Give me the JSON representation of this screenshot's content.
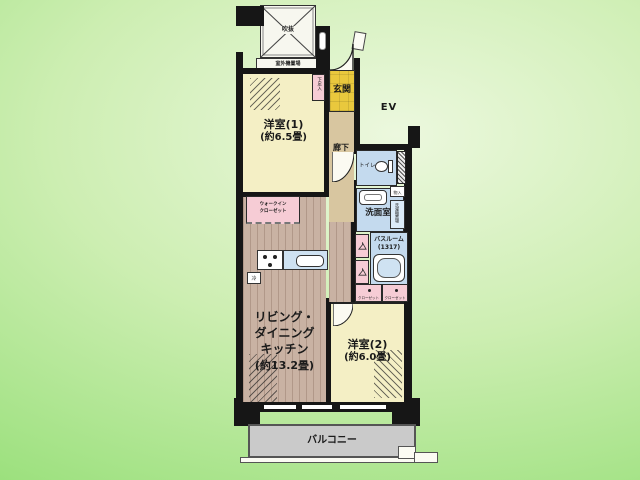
{
  "scene": {
    "ev_label": "EV"
  },
  "plan": {
    "void": "吹抜",
    "outdoor_unit": "室外機置場",
    "entrance": "玄関",
    "shoe_cabinet": "下足入",
    "hallway": "廊下",
    "toilet": "トイレ",
    "washroom": "洗面室",
    "bathroom_name": "バスルーム",
    "bathroom_size": "(1317)",
    "storage": "物入",
    "laundry": "洗濯機置場",
    "room1_name": "洋室(1)",
    "room1_size": "(約6.5畳)",
    "room2_name": "洋室(2)",
    "room2_size": "(約6.0畳)",
    "ldk_line1": "リビング・",
    "ldk_line2": "ダイニング",
    "ldk_line3": "キッチン",
    "ldk_size": "(約13.2畳)",
    "wic_line1": "ウォークイン",
    "wic_line2": "クローゼット",
    "closet_left": "クローゼット",
    "closet_right": "クローゼット",
    "fridge": "冷",
    "balcony": "バルコニー"
  },
  "colors": {
    "background_light": "#ecf8de",
    "background_dark": "#93de74",
    "room_cream": "#f4efc5",
    "entrance_gold": "#e9c83d",
    "closet_pink": "#f6ccd5",
    "wet_area_blue": "#c4daee",
    "hallway_tan": "#d8c6a0",
    "ldk_wood": "#c9b2a3",
    "balcony_gray": "#cacaca",
    "wall_black": "#161616"
  }
}
